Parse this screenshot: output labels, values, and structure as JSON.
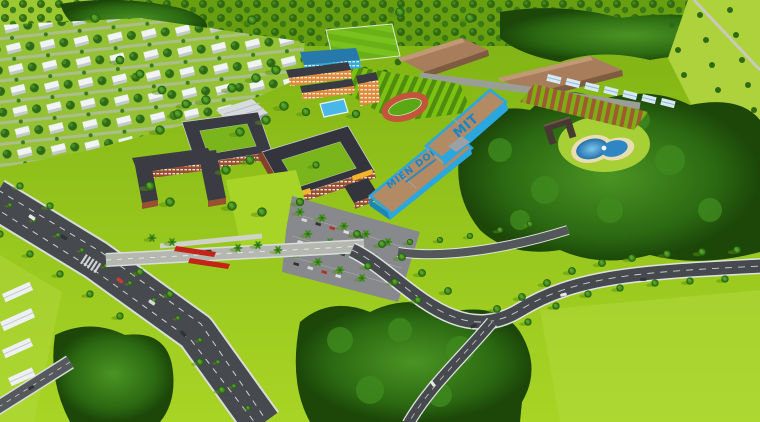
{
  "scene": {
    "type": "aerial-3d-render",
    "description": "Bird's-eye 3D architectural rendering of a university campus: terracotta academic buildings, two blue workshop halls with roof lettering, sports fields, farmland plots, a landscaped pond with villa, rows of white residential houses and tree-lined curving roads.",
    "roof_labels": {
      "near_hall": "MIEN DONG",
      "far_hall": "MIT"
    },
    "palette": {
      "lawn": "#9ccb1f",
      "lawn_light": "#b5da3b",
      "forest_green": "#2d6914",
      "asphalt": "#46494d",
      "concrete": "#b5b8b0",
      "sidewalk": "#dfe3e0",
      "brick": "#9a5030",
      "dark_roof": "#35363d",
      "workshop_blue": "#2aa7df",
      "workshop_roof": "#b28a64",
      "roof_text": "#1486c9",
      "orange_block": "#e08b3a",
      "white_house": "#eef2f4",
      "warehouse_roof": "#a87d5b",
      "pond_water": "#2f86c5",
      "pond_sand": "#e9ddb4",
      "track_red": "#c4543a",
      "flower_red": "#c32418",
      "pool_blue": "#49b7e8",
      "greenhouse": "#d8e9f4"
    }
  }
}
